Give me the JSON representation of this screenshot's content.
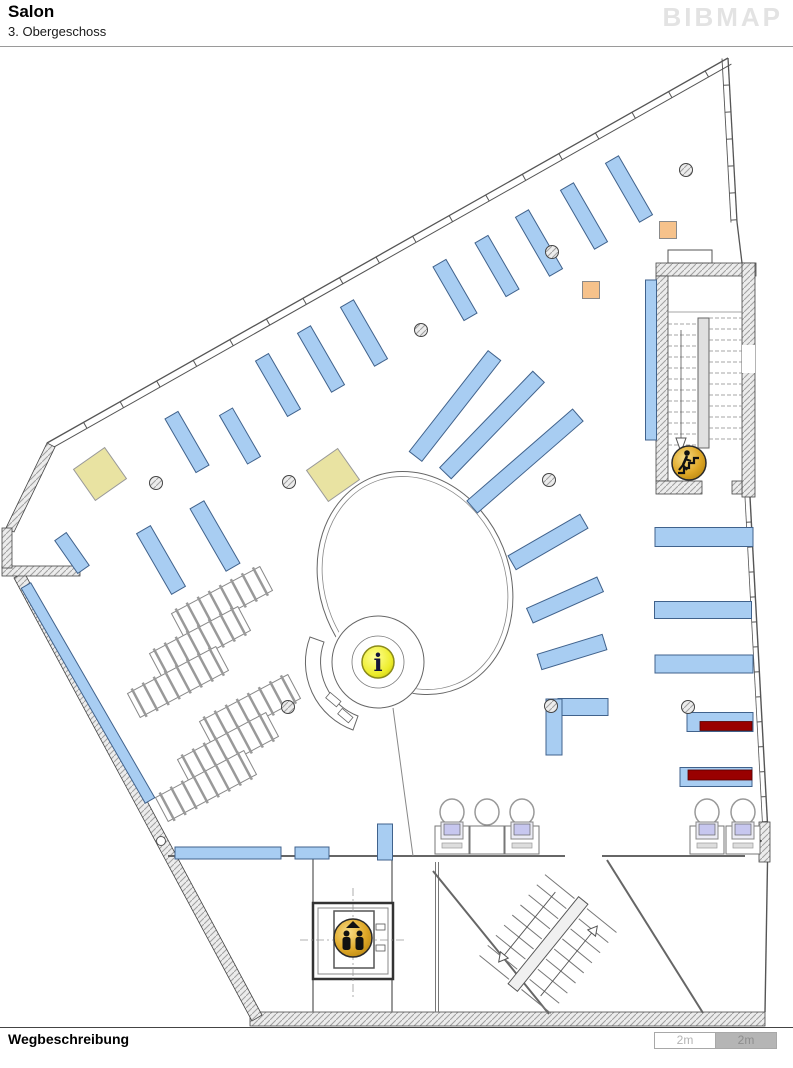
{
  "header": {
    "title": "Salon",
    "subtitle": "3. Obergeschoss",
    "logo": "BIBMAP"
  },
  "footer": {
    "label": "Wegbeschreibung",
    "scale": {
      "segments": [
        {
          "label": "2m"
        },
        {
          "label": "2m"
        }
      ]
    }
  },
  "map": {
    "colors": {
      "shelf": "#a8cdf2",
      "shelfBorder": "#40628c",
      "highlight": "#990000",
      "yellow": "#e9e3a2",
      "orange": "#f6c28b",
      "wall": "#555555",
      "gold": "#e0a929",
      "infoYellow": "#efef3a",
      "monitor": "#c7c7ef",
      "scaleGray": "#b5b5b5"
    },
    "icons": [
      {
        "name": "info-icon",
        "glyph": "i",
        "x": 378,
        "y": 662,
        "r": 16
      },
      {
        "name": "elevator-icon",
        "x": 353,
        "y": 938,
        "r": 19
      },
      {
        "name": "stairs-icon",
        "x": 689,
        "y": 463,
        "r": 17
      }
    ],
    "shelves": [
      {
        "x": 629,
        "y": 189,
        "l": 68,
        "w": 15,
        "a": -30
      },
      {
        "x": 584,
        "y": 216,
        "l": 68,
        "w": 15,
        "a": -30
      },
      {
        "x": 539,
        "y": 243,
        "l": 68,
        "w": 15,
        "a": -30
      },
      {
        "x": 497,
        "y": 266,
        "l": 62,
        "w": 15,
        "a": -30
      },
      {
        "x": 455,
        "y": 290,
        "l": 62,
        "w": 15,
        "a": -30
      },
      {
        "x": 364,
        "y": 333,
        "l": 68,
        "w": 15,
        "a": -30
      },
      {
        "x": 321,
        "y": 359,
        "l": 68,
        "w": 15,
        "a": -30
      },
      {
        "x": 278,
        "y": 385,
        "l": 64,
        "w": 15,
        "a": -30
      },
      {
        "x": 187,
        "y": 442,
        "l": 62,
        "w": 15,
        "a": -30
      },
      {
        "x": 240,
        "y": 436,
        "l": 56,
        "w": 15,
        "a": -30
      },
      {
        "x": 215,
        "y": 536,
        "l": 72,
        "w": 16,
        "a": -30
      },
      {
        "x": 161,
        "y": 560,
        "l": 70,
        "w": 16,
        "a": -30
      },
      {
        "x": 72,
        "y": 553,
        "l": 40,
        "w": 14,
        "a": -35
      },
      {
        "x": 88,
        "y": 693,
        "l": 248,
        "w": 11,
        "a": -30
      },
      {
        "x": 455,
        "y": 406,
        "l": 128,
        "w": 16,
        "a": 38
      },
      {
        "x": 492,
        "y": 425,
        "l": 134,
        "w": 16,
        "a": 44
      },
      {
        "x": 525,
        "y": 461,
        "l": 140,
        "w": 16,
        "a": 49
      },
      {
        "x": 548,
        "y": 542,
        "l": 83,
        "w": 16,
        "a": 60
      },
      {
        "x": 565,
        "y": 600,
        "l": 77,
        "w": 16,
        "a": 66
      },
      {
        "x": 572,
        "y": 652,
        "l": 68,
        "w": 16,
        "a": 73
      },
      {
        "x": 583,
        "y": 707,
        "l": 50,
        "w": 17,
        "a": 90
      },
      {
        "x": 554,
        "y": 727,
        "l": 56,
        "w": 16,
        "a": 0
      },
      {
        "x": 704,
        "y": 537,
        "l": 98,
        "w": 19,
        "a": 90
      },
      {
        "x": 703,
        "y": 610,
        "l": 97,
        "w": 17,
        "a": 90
      },
      {
        "x": 704,
        "y": 664,
        "l": 98,
        "w": 18,
        "a": 90
      },
      {
        "x": 720,
        "y": 722,
        "l": 66,
        "w": 19,
        "a": 90
      },
      {
        "x": 716,
        "y": 777,
        "l": 72,
        "w": 19,
        "a": 90
      },
      {
        "x": 651,
        "y": 360,
        "l": 160,
        "w": 11,
        "a": 0
      },
      {
        "x": 228,
        "y": 853,
        "l": 106,
        "w": 12,
        "a": 90
      },
      {
        "x": 312,
        "y": 853,
        "l": 34,
        "w": 12,
        "a": 90
      },
      {
        "x": 385,
        "y": 842,
        "l": 36,
        "w": 15,
        "a": 0
      }
    ],
    "highlight_shelves": [
      {
        "x": 726,
        "y": 726,
        "l": 52,
        "w": 9,
        "a": 90
      },
      {
        "x": 720,
        "y": 775,
        "l": 64,
        "w": 10,
        "a": 90
      }
    ],
    "tables": [
      {
        "x": 100,
        "y": 474,
        "s": 38,
        "a": -35,
        "color": "yellow"
      },
      {
        "x": 333,
        "y": 475,
        "s": 38,
        "a": -35,
        "color": "yellow"
      },
      {
        "x": 591,
        "y": 290,
        "s": 17,
        "a": 0,
        "color": "orange"
      },
      {
        "x": 668,
        "y": 230,
        "s": 17,
        "a": 0,
        "color": "orange"
      }
    ],
    "columns": [
      [
        686,
        170
      ],
      [
        552,
        252
      ],
      [
        421,
        330
      ],
      [
        156,
        483
      ],
      [
        289,
        482
      ],
      [
        549,
        480
      ],
      [
        288,
        707
      ],
      [
        551,
        706
      ],
      [
        688,
        707
      ]
    ],
    "racks": [
      {
        "x": 222,
        "y": 602,
        "a": -28
      },
      {
        "x": 200,
        "y": 642,
        "a": -28
      },
      {
        "x": 178,
        "y": 682,
        "a": -28
      },
      {
        "x": 250,
        "y": 710,
        "a": -28
      },
      {
        "x": 228,
        "y": 748,
        "a": -28
      },
      {
        "x": 206,
        "y": 786,
        "a": -28
      }
    ],
    "workstations": [
      {
        "x": 452,
        "monitor": true
      },
      {
        "x": 487,
        "monitor": false
      },
      {
        "x": 522,
        "monitor": true
      },
      {
        "x": 707,
        "monitor": true
      },
      {
        "x": 743,
        "monitor": true
      }
    ]
  }
}
